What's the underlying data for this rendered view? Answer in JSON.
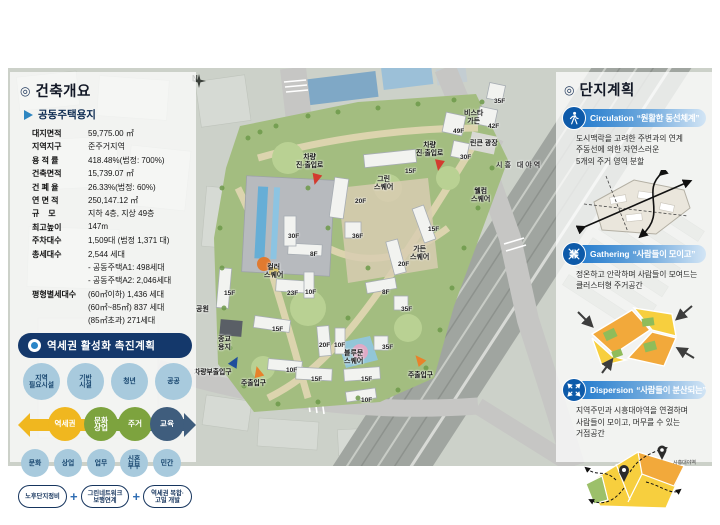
{
  "colors": {
    "banner_navy": "#14386b",
    "accent_blue": "#2b86c8",
    "flow_yellow": "#f0b71f",
    "flow_green": "#7da33e",
    "flow_slate": "#3f5d7d",
    "entry_red": "#d23b2f",
    "entry_orange": "#e8822a",
    "entry_blue": "#1f4e9c",
    "section_blue": "#0d5aa9"
  },
  "left_panel": {
    "header_icon": "◎",
    "title": "건축개요",
    "subtitle": "공동주택용지",
    "table": [
      {
        "label": "대지면적",
        "value": "59,775.00 ㎡"
      },
      {
        "label": "지역지구",
        "value": "준주거지역"
      },
      {
        "label": "용 적 률",
        "value": "418.48%(법정: 700%)"
      },
      {
        "label": "건축면적",
        "value": "15,739.07 ㎡"
      },
      {
        "label": "건 폐 율",
        "value": "26.33%(법정: 60%)"
      },
      {
        "label": "연 면 적",
        "value": "250,147.12 ㎡"
      },
      {
        "label": "규    모",
        "value": "지하 4층, 지상 49층"
      },
      {
        "label": "최고높이",
        "value": "147m"
      },
      {
        "label": "주차대수",
        "value": "1,509대 (법정 1,371 대)"
      },
      {
        "label": "총세대수",
        "value": "2,544 세대"
      },
      {
        "label": "",
        "value": "- 공동주택A1: 498세대"
      },
      {
        "label": "",
        "value": "- 공동주택A2: 2,046세대"
      },
      {
        "label": "평형별세대수",
        "value": "(60㎡이하) 1,436 세대"
      },
      {
        "label": "",
        "value": "(60㎡~85㎡) 837 세대"
      },
      {
        "label": "",
        "value": "(85㎡초과) 271세대"
      }
    ]
  },
  "station_plan": {
    "title": "역세권 활성화 촉진계획",
    "top_bubbles": [
      {
        "label": "지역\n필요시설"
      },
      {
        "label": "기반\n시설"
      },
      {
        "label": "청년"
      },
      {
        "label": "공공"
      }
    ],
    "flow_steps": [
      {
        "label": "역세권",
        "color": "#f0b71f",
        "x": 30,
        "y": 4
      },
      {
        "label": "문화\n상업",
        "color": "#7da33e",
        "x": 66,
        "y": 4
      },
      {
        "label": "주거",
        "color": "#7da33e",
        "x": 100,
        "y": 4
      },
      {
        "label": "교육",
        "color": "#3f5d7d",
        "x": 132,
        "y": 4
      }
    ],
    "bottom_bubbles": [
      {
        "label": "문화"
      },
      {
        "label": "상업"
      },
      {
        "label": "업무"
      },
      {
        "label": "신혼\n부부"
      },
      {
        "label": "민간"
      }
    ],
    "pills": [
      {
        "label": "노후단지정비"
      },
      {
        "label": "그린네트워크\n보행연계"
      },
      {
        "label": "역세권 복합·\n고밀 개발"
      }
    ],
    "plus_sign": "+"
  },
  "site_plan": {
    "header_icon": "◎",
    "title": "단지계획",
    "sections": [
      {
        "en": "Circulation",
        "kr": "“원활한 동선체계”",
        "lines": [
          "도시맥락을 고려한 주변과의 연계",
          "주동선에 의한 자연스러운",
          "5개의 주거 영역 분할"
        ]
      },
      {
        "en": "Gathering",
        "kr": "“사람들이 모이고”",
        "lines": [
          "정온하고 안락하며 사람들이 모여드는",
          "클러스터형 주거공간"
        ]
      },
      {
        "en": "Dispersion",
        "kr": "“사람들이 분산되는”",
        "lines": [
          "지역주민과 시흥대야역을 연결하며",
          "사람들이 모이고, 머무를 수 있는",
          "거점공간"
        ]
      }
    ],
    "station_label": "시흥대야역"
  },
  "map": {
    "compass": "N",
    "floor_labels": [
      {
        "text": "49F",
        "x": 445,
        "y": 60
      },
      {
        "text": "42F",
        "x": 480,
        "y": 55
      },
      {
        "text": "35F",
        "x": 486,
        "y": 30
      },
      {
        "text": "30F",
        "x": 452,
        "y": 86
      },
      {
        "text": "15F",
        "x": 397,
        "y": 100
      },
      {
        "text": "20F",
        "x": 347,
        "y": 130
      },
      {
        "text": "36F",
        "x": 344,
        "y": 165
      },
      {
        "text": "30F",
        "x": 280,
        "y": 165
      },
      {
        "text": "8F",
        "x": 302,
        "y": 183
      },
      {
        "text": "15F",
        "x": 420,
        "y": 158
      },
      {
        "text": "20F",
        "x": 390,
        "y": 193
      },
      {
        "text": "15F",
        "x": 216,
        "y": 222
      },
      {
        "text": "23F",
        "x": 279,
        "y": 222
      },
      {
        "text": "10F",
        "x": 297,
        "y": 221
      },
      {
        "text": "8F",
        "x": 374,
        "y": 221
      },
      {
        "text": "35F",
        "x": 393,
        "y": 238
      },
      {
        "text": "15F",
        "x": 264,
        "y": 258
      },
      {
        "text": "20F",
        "x": 311,
        "y": 274
      },
      {
        "text": "10F",
        "x": 326,
        "y": 274
      },
      {
        "text": "35F",
        "x": 374,
        "y": 276
      },
      {
        "text": "10F",
        "x": 278,
        "y": 299
      },
      {
        "text": "15F",
        "x": 303,
        "y": 308
      },
      {
        "text": "15F",
        "x": 353,
        "y": 308
      },
      {
        "text": "10F",
        "x": 353,
        "y": 329
      }
    ],
    "place_labels": [
      {
        "text": "그린\n스퀘어",
        "x": 366,
        "y": 108
      },
      {
        "text": "비스타\n가든",
        "x": 456,
        "y": 42
      },
      {
        "text": "린큰 광장",
        "x": 462,
        "y": 72
      },
      {
        "text": "시흥 대야역",
        "x": 488,
        "y": 94,
        "cls": "station"
      },
      {
        "text": "웰컴\n스퀘어",
        "x": 463,
        "y": 120
      },
      {
        "text": "가든\n스퀘어",
        "x": 402,
        "y": 178
      },
      {
        "text": "컬러\n스퀘어",
        "x": 256,
        "y": 196
      },
      {
        "text": "블루문\n스퀘어",
        "x": 336,
        "y": 282
      },
      {
        "text": "공원",
        "x": 188,
        "y": 238
      },
      {
        "text": "종교\n용지",
        "x": 210,
        "y": 268
      }
    ],
    "entrance_labels": [
      {
        "text": "차량\n진·출입로",
        "x": 288,
        "y": 86
      },
      {
        "text": "차량\n진·출입로",
        "x": 408,
        "y": 74
      },
      {
        "text": "차량부출입구",
        "x": 186,
        "y": 301
      },
      {
        "text": "주출입구",
        "x": 233,
        "y": 312
      },
      {
        "text": "주출입구",
        "x": 400,
        "y": 304
      }
    ]
  }
}
